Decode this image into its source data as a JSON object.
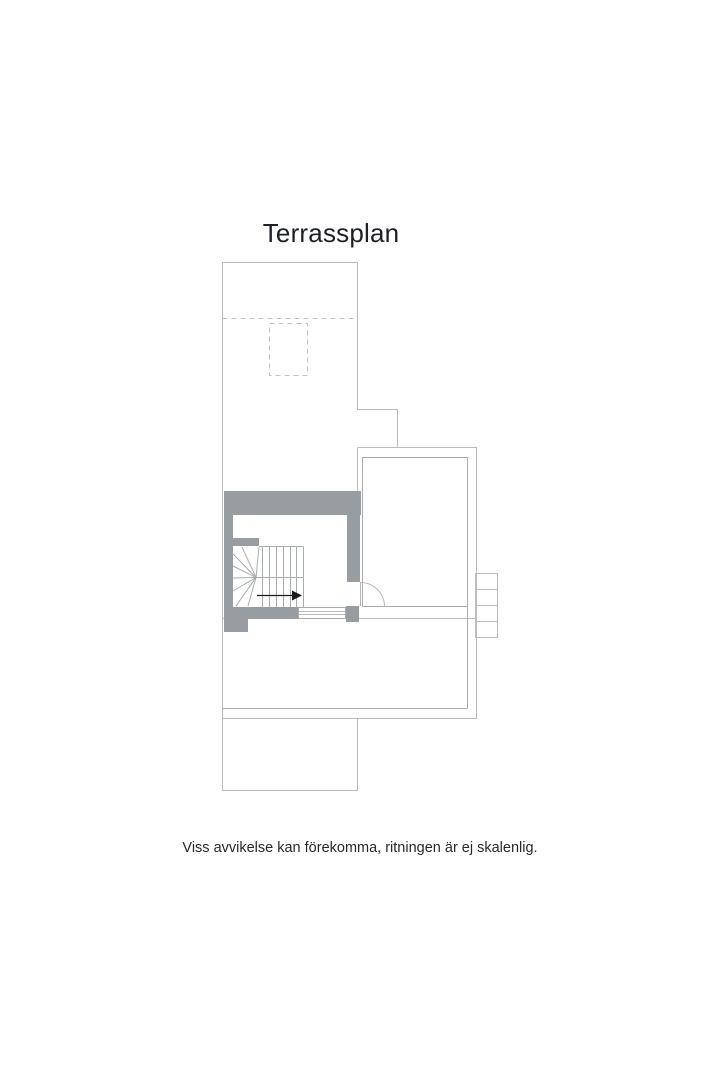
{
  "page": {
    "background": "#ffffff"
  },
  "floor_plan": {
    "title": "Terrassplan",
    "disclaimer": "Viss avvikelse kan förekomma, ritningen är ej skalenlig.",
    "colors": {
      "wall_fill": "#979da0",
      "outline_line": "#b9bcbe",
      "detail_line": "#a7acaf",
      "dashed_line": "#c0c3c5",
      "arrow": "#1a1a1a",
      "title_text": "#1d2125",
      "disclaimer_text": "#26292c"
    },
    "icons": {
      "direction_arrow": "stair-direction-arrow-icon"
    }
  }
}
